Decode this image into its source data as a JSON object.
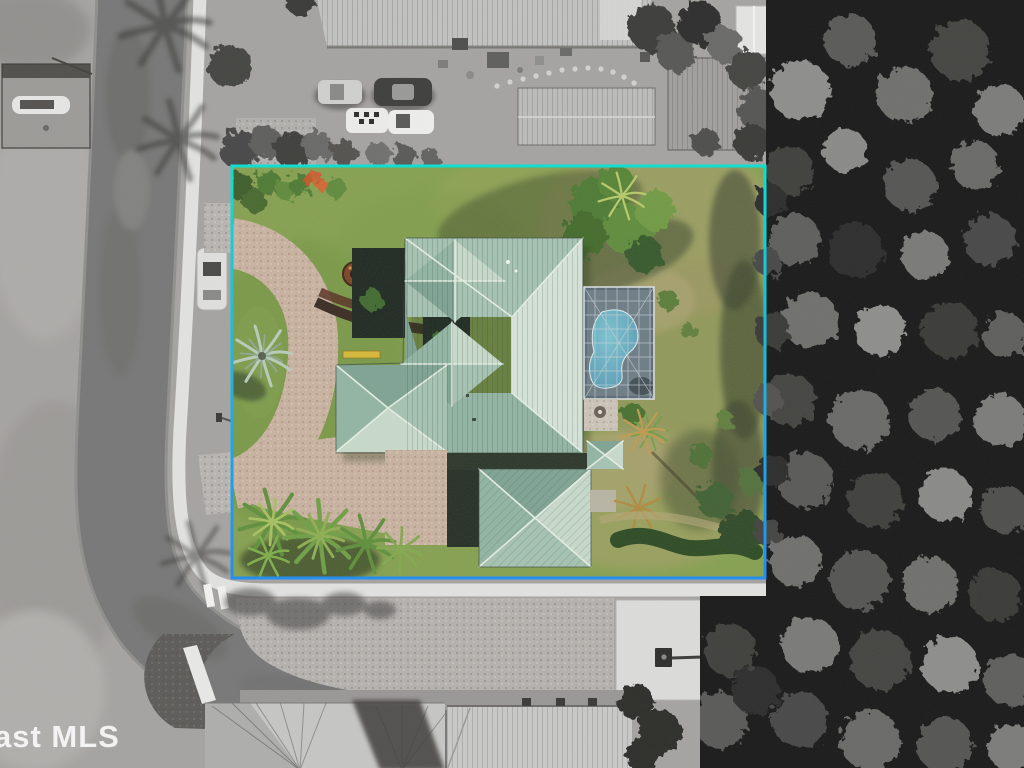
{
  "scene": {
    "type": "aerial-photograph"
  },
  "watermark": {
    "text": "ast MLS"
  },
  "boundary": {
    "x": 232,
    "y": 166,
    "width": 533,
    "height": 412,
    "stroke_width": 3
  },
  "colors": {
    "boundary_top": "#0adfd2",
    "boundary_mid": "#18b4e0",
    "boundary_bottom": "#1e8df2",
    "lawn": "#85a04f",
    "lawn_dry": "#a49e67",
    "roof_main": "#d6e4d8",
    "roof_mid": "#a6c3b2",
    "ridge_cap": "#e6efe4",
    "pool_water": "#7cc4d2",
    "pool_water_deep": "#4f93ad",
    "screen_enclosure": "#5b6a74",
    "pavers": "#c9b2a0",
    "mulch_path": "#3a2a20",
    "road_asphalt": "#787878",
    "sidewalk": "#e2e2e0",
    "gray_ground": "#a6a4a1",
    "gray_roof": "#c2c2c0",
    "concrete_pad": "#dcdcda",
    "tree_canopy_dark": "#1b1b1b",
    "hedge_green": "#2c4a22",
    "palm_green": "#6f9f45"
  }
}
